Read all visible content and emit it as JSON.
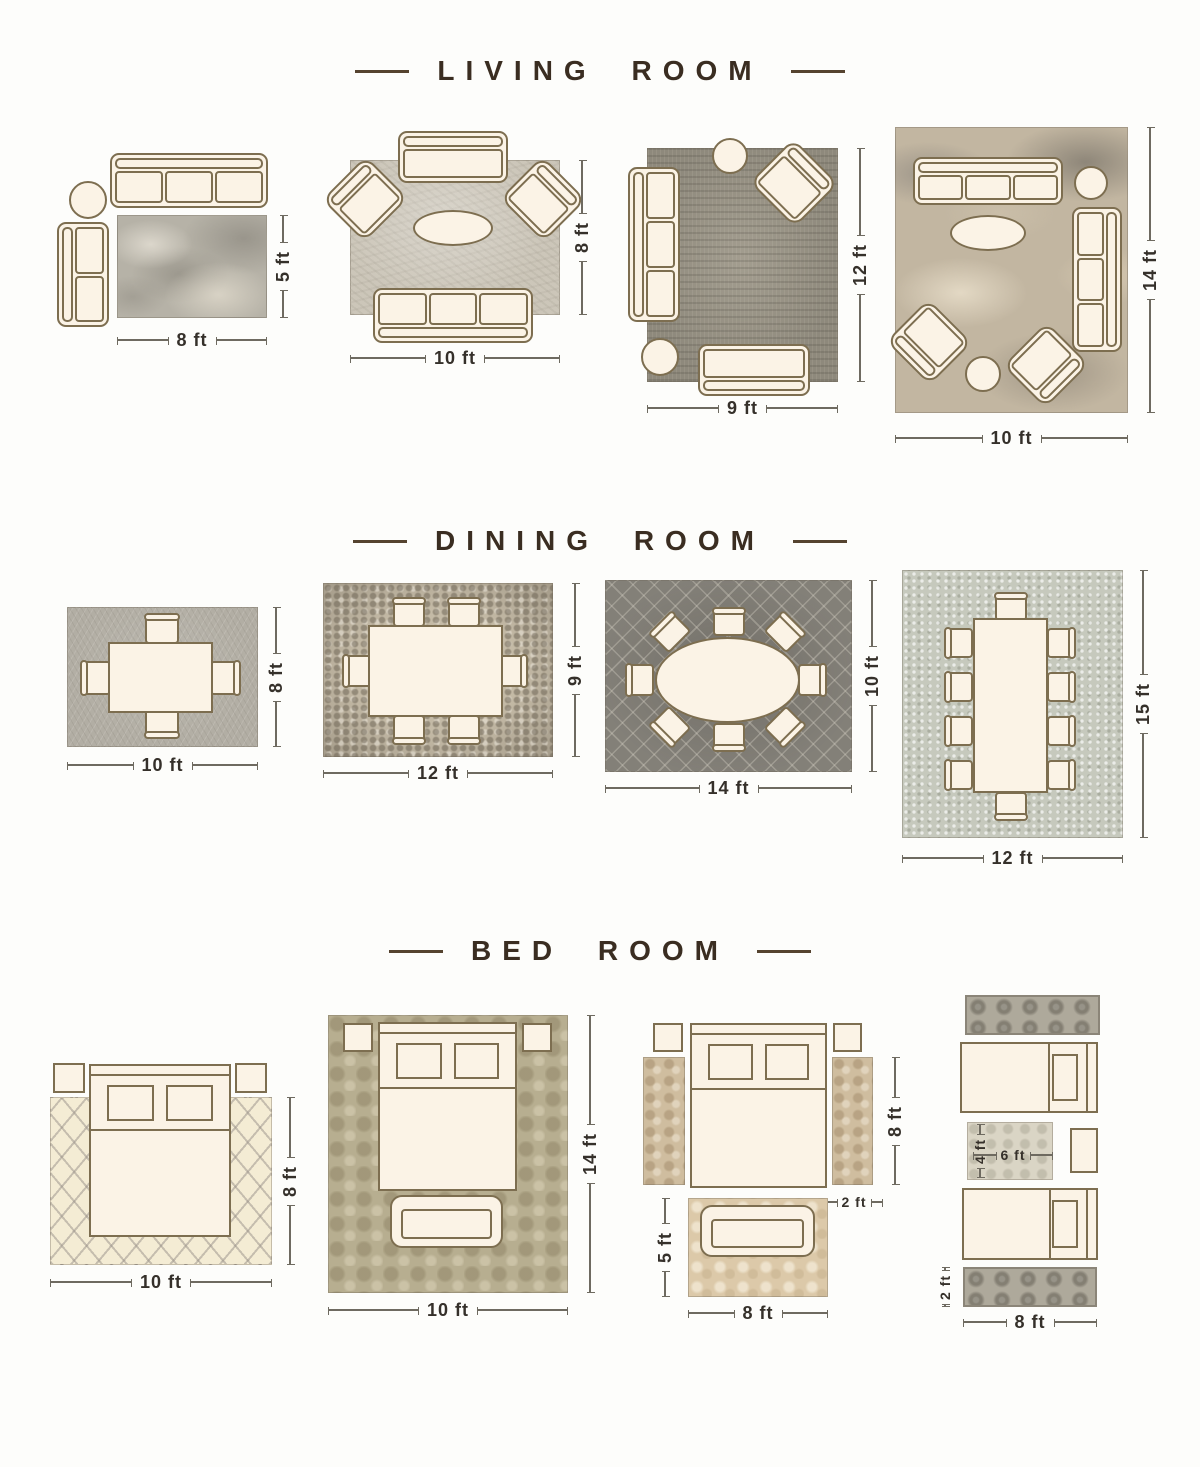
{
  "colors": {
    "background": "#fdfdfb",
    "furniture_fill": "#fbf3e6",
    "furniture_outline": "#7d6e50",
    "title_text": "#3a2d21",
    "dimension_text": "#35302a",
    "dimension_line": "#6e6a60"
  },
  "sections": [
    {
      "title": "LIVING ROOM",
      "layouts": [
        {
          "width": "8 ft",
          "height": "5 ft"
        },
        {
          "width": "10 ft",
          "height": "8 ft"
        },
        {
          "width": "9 ft",
          "height": "12 ft"
        },
        {
          "width": "10 ft",
          "height": "14 ft"
        }
      ]
    },
    {
      "title": "DINING ROOM",
      "layouts": [
        {
          "width": "10 ft",
          "height": "8 ft"
        },
        {
          "width": "12 ft",
          "height": "9 ft"
        },
        {
          "width": "14 ft",
          "height": "10 ft"
        },
        {
          "width": "12 ft",
          "height": "15 ft"
        }
      ]
    },
    {
      "title": "BED ROOM",
      "layouts": [
        {
          "width": "10 ft",
          "height": "8 ft"
        },
        {
          "width": "10 ft",
          "height": "14 ft"
        },
        {
          "rug_width": "8 ft",
          "rug_height": "5 ft",
          "runner_length": "8 ft",
          "runner_width": "2 ft"
        },
        {
          "rug_width": "6 ft",
          "rug_height": "4 ft",
          "runner_length": "8 ft",
          "runner_width": "2 ft"
        }
      ]
    }
  ]
}
